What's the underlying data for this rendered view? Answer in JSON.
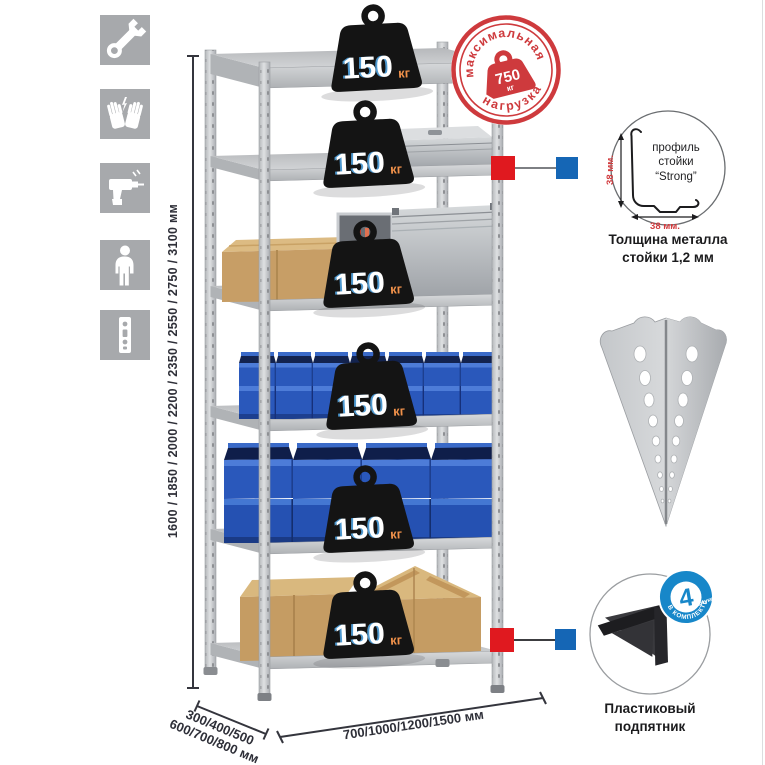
{
  "sidebar_icons": [
    {
      "name": "wrench-icon"
    },
    {
      "name": "gloves-icon"
    },
    {
      "name": "drill-icon"
    },
    {
      "name": "person-icon"
    },
    {
      "name": "rack-post-icon"
    }
  ],
  "rack": {
    "shelf_count": 6,
    "shelf_load": {
      "value": "150",
      "unit": "кг"
    }
  },
  "max_load_stamp": {
    "arc_top": "максимальная",
    "arc_bottom": "нагрузка",
    "value": "750",
    "unit": "кг"
  },
  "dimensions": {
    "height": "1600 / 1850 / 2000 / 2200 / 2350 / 2550 / 2750 / 3100 мм",
    "depth_line1": "300/400/500",
    "depth_line2": "600/700/800 мм",
    "width": "700/1000/1200/1500 мм"
  },
  "profile_detail": {
    "label_line1": "профиль",
    "label_line2": "стойки",
    "label_line3": "“Strong”",
    "vertical_dim": "38 мм.",
    "horizontal_dim": "38 мм.",
    "caption_line1": "Толщина металла",
    "caption_line2": "стойки 1,2 мм"
  },
  "foot_detail": {
    "badge_number": "4",
    "badge_unit": "штуки",
    "badge_arc": "В КОМПЛЕКТЕ",
    "caption_line1": "Пластиковый",
    "caption_line2": "подпятник"
  },
  "colors": {
    "stamp_red": "#ce3a3d",
    "marker_red": "#e0191f",
    "marker_blue": "#1566b5",
    "badge_blue": "#1787c9",
    "bin_blue": "#2a58bb",
    "frame_gray": "#c9cbcd",
    "weight_black": "#141414",
    "weight_unit_orange": "#f0914a",
    "dim_text": "#2e2f38",
    "icon_bg_gray": "#a7a9ac"
  }
}
